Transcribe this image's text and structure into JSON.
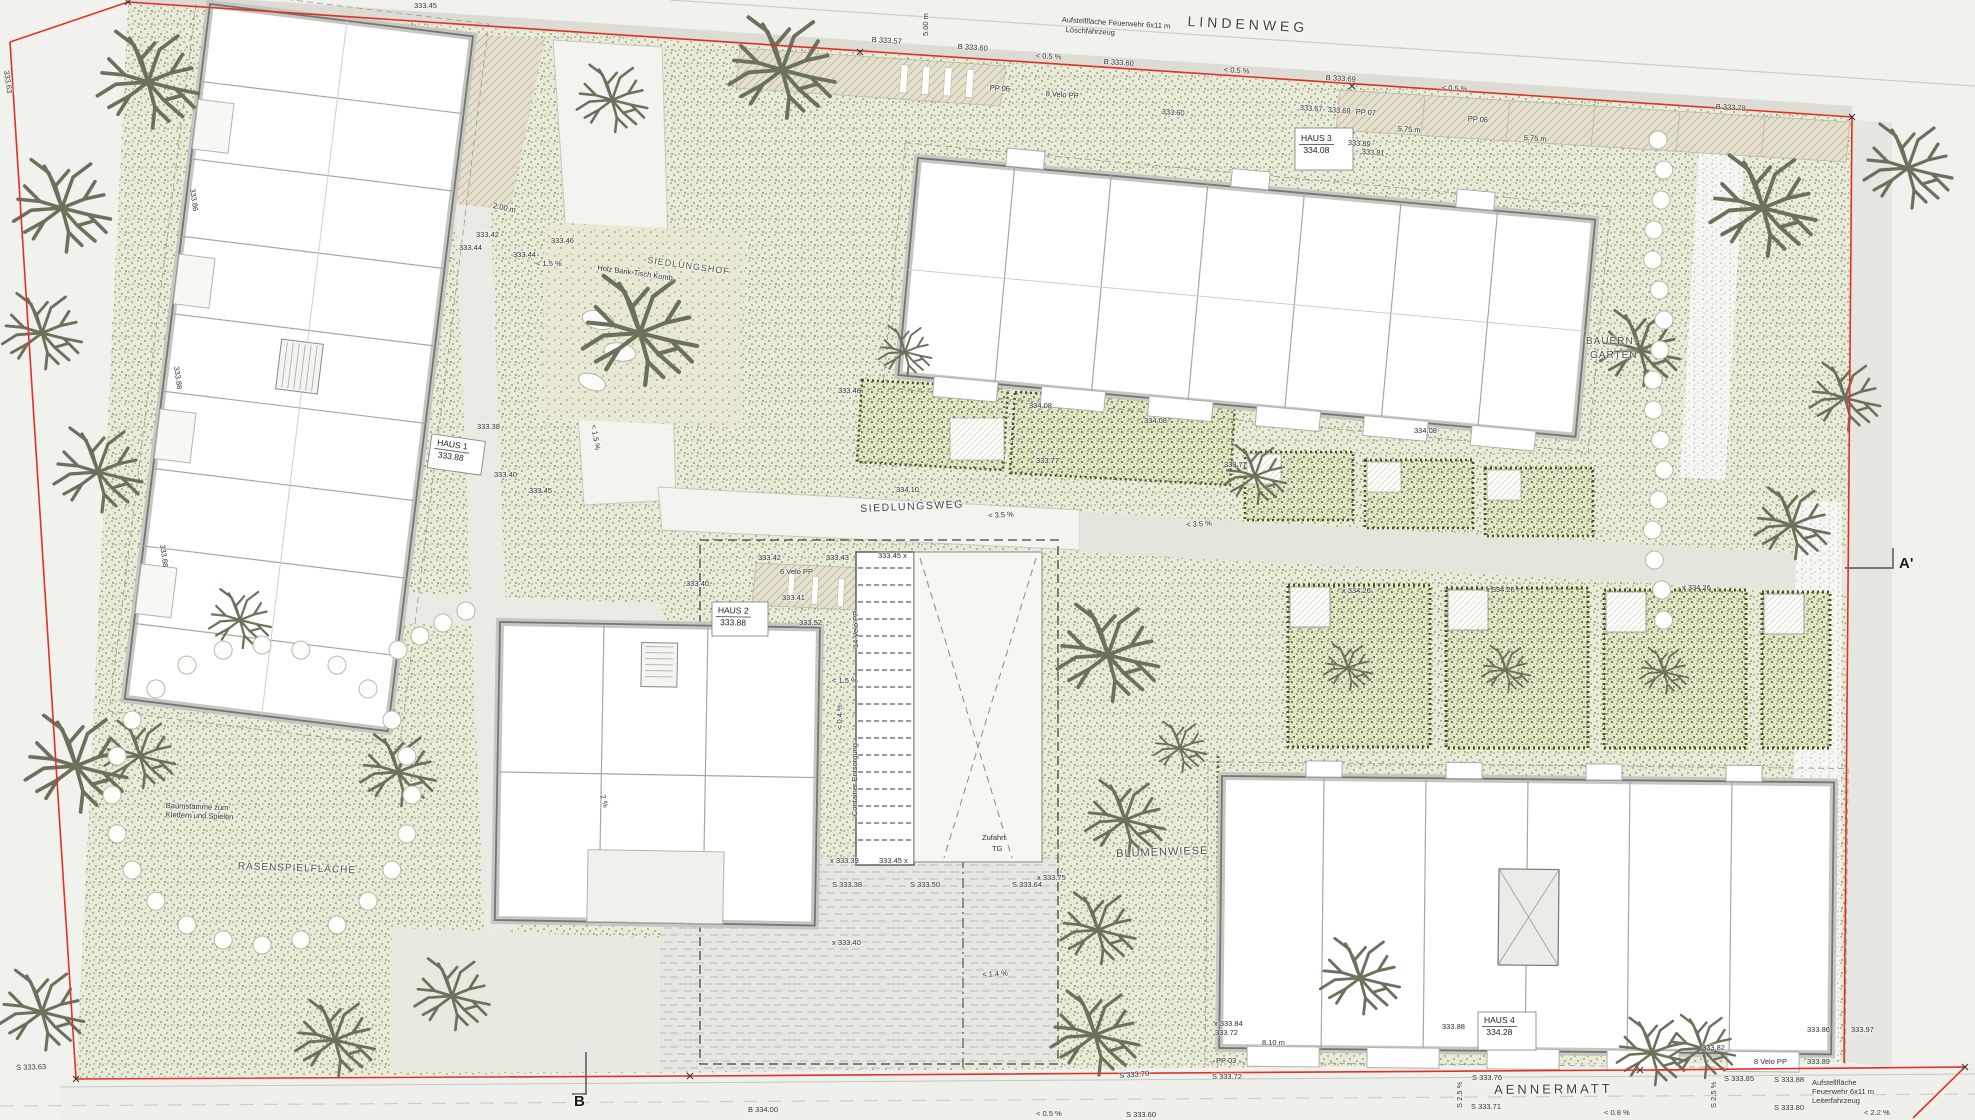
{
  "plan": {
    "title": "Siedlung Aennermatt – Umgebungsplan",
    "boundary_color": "#e23127",
    "streets": [
      {
        "name": "LINDENWEG",
        "x": 1188,
        "y": 14,
        "r": 3,
        "size": 14,
        "ls": 4
      },
      {
        "name": "SIEDLUNGSWEG",
        "x": 860,
        "y": 504,
        "r": -2.5,
        "size": 10.5,
        "ls": 1.5
      },
      {
        "name": "AENNERMATT",
        "x": 1494,
        "y": 1083,
        "r": -0.5,
        "size": 13,
        "ls": 3
      }
    ],
    "areas": [
      {
        "name": "SIEDLUNGSHOF",
        "x": 648,
        "y": 256,
        "r": 8,
        "size": 9,
        "ls": 1
      },
      {
        "name": "RASENSPIELFLÄCHE",
        "x": 238,
        "y": 862,
        "r": 2,
        "size": 10,
        "ls": 1
      },
      {
        "name": "BLUMENWIESE",
        "x": 1116,
        "y": 849,
        "r": -2,
        "size": 11,
        "ls": 1
      },
      {
        "name": "BAUERN-",
        "x": 1586,
        "y": 337,
        "r": 0,
        "size": 10,
        "ls": 1
      },
      {
        "name": "GARTEN",
        "x": 1590,
        "y": 351,
        "r": 0,
        "size": 10,
        "ls": 1
      }
    ],
    "houses": [
      {
        "name": "HAUS 1",
        "elev": "333.88",
        "x": 436,
        "y": 437,
        "r": 8
      },
      {
        "name": "HAUS 2",
        "elev": "333.88",
        "x": 716,
        "y": 605,
        "r": 1
      },
      {
        "name": "HAUS 3",
        "elev": "334.08",
        "x": 1299,
        "y": 133,
        "r": 0
      },
      {
        "name": "HAUS 4",
        "elev": "334.28",
        "x": 1482,
        "y": 1015,
        "r": 0
      }
    ],
    "sections": [
      {
        "name": "A'",
        "x": 1899,
        "y": 556
      },
      {
        "name": "B",
        "x": 574,
        "y": 1094
      }
    ],
    "annotations": [
      {
        "t": "Aufstellfläche Feuerwehr 6x11 m",
        "x": 1062,
        "y": 16,
        "r": 3.5
      },
      {
        "t": "Löschfahrzeug",
        "x": 1066,
        "y": 26,
        "r": 3.5
      },
      {
        "t": "B 333.57",
        "x": 872,
        "y": 36,
        "r": 3.5
      },
      {
        "t": "B 333.60",
        "x": 958,
        "y": 43,
        "r": 3.5
      },
      {
        "t": "< 0.5 %",
        "x": 1036,
        "y": 52,
        "r": 3.5
      },
      {
        "t": "B 333.60",
        "x": 1104,
        "y": 58,
        "r": 3.5
      },
      {
        "t": "< 0.5 %",
        "x": 1224,
        "y": 66,
        "r": 3.5
      },
      {
        "t": "B 333.69",
        "x": 1326,
        "y": 74,
        "r": 3.5
      },
      {
        "t": "< 0.5 %",
        "x": 1442,
        "y": 84,
        "r": 3.5
      },
      {
        "t": "B 333.78",
        "x": 1716,
        "y": 103,
        "r": 3.5
      },
      {
        "t": "5.00 m",
        "x": 922,
        "y": 36,
        "r": -90
      },
      {
        "t": "PP 06",
        "x": 990,
        "y": 84,
        "r": 4
      },
      {
        "t": "8 Velo PP",
        "x": 1046,
        "y": 90,
        "r": 4
      },
      {
        "t": "333.60",
        "x": 1162,
        "y": 108,
        "r": 4
      },
      {
        "t": "333.45",
        "x": 414,
        "y": 2,
        "r": 0
      },
      {
        "t": "333.67",
        "x": 1300,
        "y": 104,
        "r": 4
      },
      {
        "t": "333.69",
        "x": 1328,
        "y": 106,
        "r": 4
      },
      {
        "t": "PP 07",
        "x": 1356,
        "y": 108,
        "r": 4
      },
      {
        "t": "333.89",
        "x": 1348,
        "y": 139,
        "r": 4
      },
      {
        "t": "333.81",
        "x": 1362,
        "y": 148,
        "r": 4
      },
      {
        "t": "5.75 m",
        "x": 1398,
        "y": 125,
        "r": 4
      },
      {
        "t": "PP 06",
        "x": 1468,
        "y": 115,
        "r": 4
      },
      {
        "t": "5.75 m",
        "x": 1524,
        "y": 134,
        "r": 4
      },
      {
        "t": "333.63",
        "x": 10,
        "y": 70,
        "r": 82
      },
      {
        "t": "333.86",
        "x": 196,
        "y": 188,
        "r": 82
      },
      {
        "t": "333.88",
        "x": 180,
        "y": 366,
        "r": 82
      },
      {
        "t": "333.88",
        "x": 166,
        "y": 544,
        "r": 82
      },
      {
        "t": "S 333.63",
        "x": 16,
        "y": 1064,
        "r": -2
      },
      {
        "t": "2.00 m",
        "x": 494,
        "y": 202,
        "r": 12
      },
      {
        "t": "333.42",
        "x": 476,
        "y": 231,
        "r": 0
      },
      {
        "t": "333.44",
        "x": 459,
        "y": 244,
        "r": 0
      },
      {
        "t": "333.44",
        "x": 513,
        "y": 251,
        "r": 0
      },
      {
        "t": "333.46",
        "x": 551,
        "y": 237,
        "r": 0
      },
      {
        "t": "< 1.5 %",
        "x": 536,
        "y": 260,
        "r": 0
      },
      {
        "t": "< 1.5 %",
        "x": 597,
        "y": 424,
        "r": 80
      },
      {
        "t": "333.38",
        "x": 477,
        "y": 423,
        "r": 0
      },
      {
        "t": "333.40",
        "x": 494,
        "y": 471,
        "r": 0
      },
      {
        "t": "333.45",
        "x": 529,
        "y": 487,
        "r": 0
      },
      {
        "t": "Holz Bank-Tisch Komb.",
        "x": 598,
        "y": 264,
        "r": 8
      },
      {
        "t": "333.48",
        "x": 838,
        "y": 387,
        "r": 0
      },
      {
        "t": "334.10",
        "x": 896,
        "y": 486,
        "r": 0
      },
      {
        "t": "< 3.5 %",
        "x": 988,
        "y": 512,
        "r": -3
      },
      {
        "t": "< 3.5 %",
        "x": 1186,
        "y": 521,
        "r": -3
      },
      {
        "t": "334.08",
        "x": 1029,
        "y": 402,
        "r": 0
      },
      {
        "t": "333.77",
        "x": 1036,
        "y": 457,
        "r": 0
      },
      {
        "t": "334.08",
        "x": 1144,
        "y": 417,
        "r": 0
      },
      {
        "t": "333.77",
        "x": 1224,
        "y": 461,
        "r": 0
      },
      {
        "t": "334.08",
        "x": 1414,
        "y": 427,
        "r": 0
      },
      {
        "t": "333.41",
        "x": 782,
        "y": 594,
        "r": 0
      },
      {
        "t": "333.42",
        "x": 758,
        "y": 554,
        "r": 0
      },
      {
        "t": "333.43",
        "x": 826,
        "y": 554,
        "r": 0
      },
      {
        "t": "333.45 x",
        "x": 878,
        "y": 552,
        "r": 0
      },
      {
        "t": "6 Velo PP",
        "x": 780,
        "y": 568,
        "r": 0
      },
      {
        "t": "333.40",
        "x": 686,
        "y": 580,
        "r": 0
      },
      {
        "t": "333.52",
        "x": 799,
        "y": 619,
        "r": 0
      },
      {
        "t": "14 Velo PP",
        "x": 852,
        "y": 648,
        "r": -90
      },
      {
        "t": "Container Entsorgung",
        "x": 851,
        "y": 816,
        "r": -90
      },
      {
        "t": "< 1.5 %",
        "x": 832,
        "y": 677,
        "r": 0
      },
      {
        "t": "< 0.4 %",
        "x": 836,
        "y": 730,
        "r": -90
      },
      {
        "t": "Zufahrt",
        "x": 982,
        "y": 834,
        "r": 0
      },
      {
        "t": "TG",
        "x": 992,
        "y": 845,
        "r": 0
      },
      {
        "t": "x 333.39",
        "x": 830,
        "y": 857,
        "r": 0
      },
      {
        "t": "333.45 x",
        "x": 879,
        "y": 857,
        "r": 0
      },
      {
        "t": "S 333.38",
        "x": 832,
        "y": 881,
        "r": 0
      },
      {
        "t": "S 333.50",
        "x": 910,
        "y": 881,
        "r": 0
      },
      {
        "t": "S 333.64",
        "x": 1012,
        "y": 881,
        "r": 0
      },
      {
        "t": "x 333.75",
        "x": 1037,
        "y": 874,
        "r": 0
      },
      {
        "t": "x 333.40",
        "x": 832,
        "y": 939,
        "r": 0
      },
      {
        "t": "< 1.4 %",
        "x": 982,
        "y": 971,
        "r": -3
      },
      {
        "t": "2 %",
        "x": 606,
        "y": 794,
        "r": 75
      },
      {
        "t": "Baumstämme zum",
        "x": 166,
        "y": 802,
        "r": 2
      },
      {
        "t": "Klettern und Spielen",
        "x": 166,
        "y": 811,
        "r": 2
      },
      {
        "t": "x 334.26",
        "x": 1342,
        "y": 587,
        "r": 0
      },
      {
        "t": "x 334.26",
        "x": 1486,
        "y": 586,
        "r": 0
      },
      {
        "t": "x 334.26",
        "x": 1682,
        "y": 584,
        "r": 0
      },
      {
        "t": "B 334.00",
        "x": 748,
        "y": 1106,
        "r": 0
      },
      {
        "t": "< 0.5 %",
        "x": 1036,
        "y": 1110,
        "r": 0
      },
      {
        "t": "S 333.70",
        "x": 1119,
        "y": 1072,
        "r": -4
      },
      {
        "t": "S 333.72",
        "x": 1212,
        "y": 1073,
        "r": 0
      },
      {
        "t": "S 333.60",
        "x": 1126,
        "y": 1111,
        "r": 0
      },
      {
        "t": "x 333.84",
        "x": 1214,
        "y": 1020,
        "r": 0
      },
      {
        "t": "333.72",
        "x": 1215,
        "y": 1029,
        "r": 0
      },
      {
        "t": "PP 03",
        "x": 1216,
        "y": 1057,
        "r": 0
      },
      {
        "t": "8.10 m",
        "x": 1262,
        "y": 1039,
        "r": 0
      },
      {
        "t": "333.88",
        "x": 1442,
        "y": 1023,
        "r": 0
      },
      {
        "t": "S 2.5 %",
        "x": 1456,
        "y": 1108,
        "r": -90
      },
      {
        "t": "S 333.76",
        "x": 1472,
        "y": 1074,
        "r": 0
      },
      {
        "t": "S 333.71",
        "x": 1471,
        "y": 1103,
        "r": 0
      },
      {
        "t": "< 0.8 %",
        "x": 1604,
        "y": 1109,
        "r": 0
      },
      {
        "t": "S 2.5 %",
        "x": 1710,
        "y": 1108,
        "r": -90
      },
      {
        "t": "333.82",
        "x": 1702,
        "y": 1044,
        "r": 0
      },
      {
        "t": "8 Velo PP",
        "x": 1754,
        "y": 1058,
        "r": 0
      },
      {
        "t": "S 333.85",
        "x": 1724,
        "y": 1075,
        "r": 0
      },
      {
        "t": "S 333.88",
        "x": 1774,
        "y": 1076,
        "r": 0
      },
      {
        "t": "S 333.80",
        "x": 1774,
        "y": 1104,
        "r": 0
      },
      {
        "t": "333.86",
        "x": 1807,
        "y": 1026,
        "r": 0
      },
      {
        "t": "333.97",
        "x": 1851,
        "y": 1026,
        "r": 0
      },
      {
        "t": "333.89",
        "x": 1807,
        "y": 1058,
        "r": 0
      },
      {
        "t": "Aufstellfläche",
        "x": 1812,
        "y": 1079,
        "r": 0
      },
      {
        "t": "Feuerwehr 6x11 m",
        "x": 1812,
        "y": 1088,
        "r": 0
      },
      {
        "t": "Leiterfahrzeug",
        "x": 1812,
        "y": 1097,
        "r": 0
      },
      {
        "t": "< 2.2 %",
        "x": 1864,
        "y": 1109,
        "r": 0
      }
    ]
  }
}
